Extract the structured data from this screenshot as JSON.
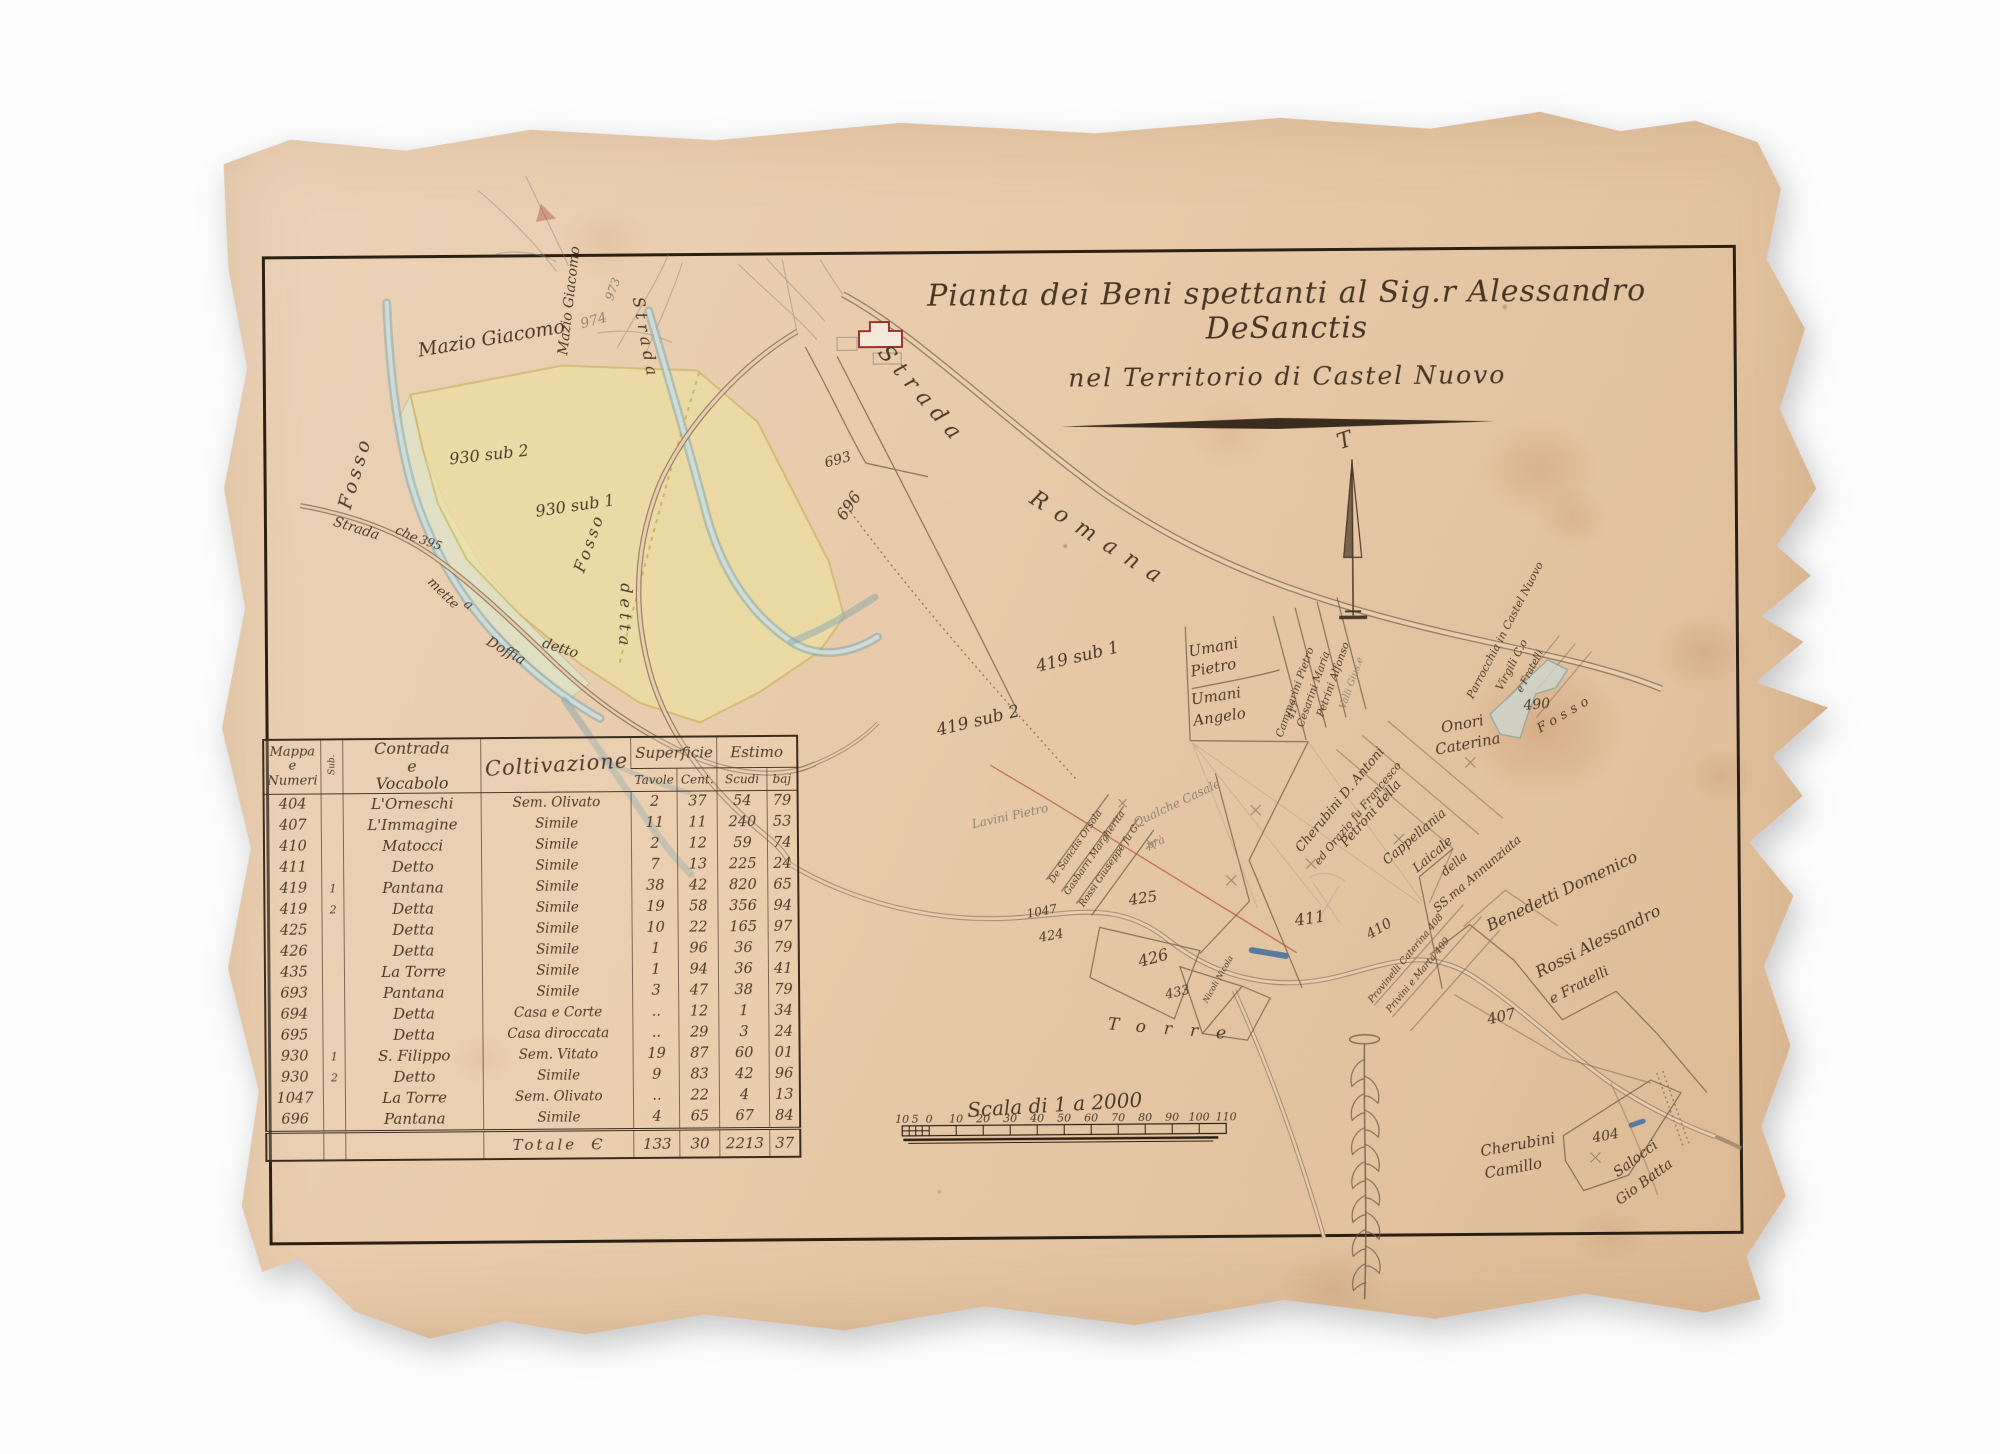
{
  "title": {
    "line1": "Pianta dei Beni spettanti al Sig.r Alessandro DeSanctis",
    "line2": "nel Territorio di Castel Nuovo"
  },
  "table": {
    "headers": {
      "mappa": "Mappa\ne\nNumeri",
      "sub": "Sub.",
      "contrada": "Contrada\ne\nVocabolo",
      "coltivazione": "Coltivazione",
      "superficie": "Superficie",
      "estimo": "Estimo",
      "tavole": "Tavole",
      "cent": "Cent.",
      "scudi": "Scudi",
      "baj": "baj"
    },
    "rows": [
      [
        "404",
        "",
        "L'Orneschi",
        "Sem. Olivato",
        "2",
        "37",
        "54",
        "79"
      ],
      [
        "407",
        "",
        "L'Immagine",
        "Simile",
        "11",
        "11",
        "240",
        "53"
      ],
      [
        "410",
        "",
        "Matocci",
        "Simile",
        "2",
        "12",
        "59",
        "74"
      ],
      [
        "411",
        "",
        "Detto",
        "Simile",
        "7",
        "13",
        "225",
        "24"
      ],
      [
        "419",
        "1",
        "Pantana",
        "Simile",
        "38",
        "42",
        "820",
        "65"
      ],
      [
        "419",
        "2",
        "Detta",
        "Simile",
        "19",
        "58",
        "356",
        "94"
      ],
      [
        "425",
        "",
        "Detta",
        "Simile",
        "10",
        "22",
        "165",
        "97"
      ],
      [
        "426",
        "",
        "Detta",
        "Simile",
        "1",
        "96",
        "36",
        "79"
      ],
      [
        "435",
        "",
        "La Torre",
        "Simile",
        "1",
        "94",
        "36",
        "41"
      ],
      [
        "693",
        "",
        "Pantana",
        "Simile",
        "3",
        "47",
        "38",
        "79"
      ],
      [
        "694",
        "",
        "Detta",
        "Casa e Corte",
        "..",
        "12",
        "1",
        "34"
      ],
      [
        "695",
        "",
        "Detta",
        "Casa diroccata",
        "..",
        "29",
        "3",
        "24"
      ],
      [
        "930",
        "1",
        "S. Filippo",
        "Sem. Vitato",
        "19",
        "87",
        "60",
        "01"
      ],
      [
        "930",
        "2",
        "Detto",
        "Simile",
        "9",
        "83",
        "42",
        "96"
      ],
      [
        "1047",
        "",
        "La Torre",
        "Sem. Olivato",
        "..",
        "22",
        "4",
        "13"
      ],
      [
        "696",
        "",
        "Pantana",
        "Simile",
        "4",
        "65",
        "67",
        "84"
      ]
    ],
    "total": {
      "label": "Totale",
      "symbol": "Є",
      "tavole": "133",
      "cent": "30",
      "scudi": "2213",
      "baj": "37"
    }
  },
  "scale_bar": {
    "label": "Scala di 1 a 2000",
    "ticks": [
      {
        "t": "10",
        "x": 899
      },
      {
        "t": "5",
        "x": 912
      },
      {
        "t": "0",
        "x": 926
      },
      {
        "t": "10",
        "x": 953
      },
      {
        "t": "20",
        "x": 980
      },
      {
        "t": "30",
        "x": 1007
      },
      {
        "t": "40",
        "x": 1034
      },
      {
        "t": "50",
        "x": 1061
      },
      {
        "t": "60",
        "x": 1088
      },
      {
        "t": "70",
        "x": 1115
      },
      {
        "t": "80",
        "x": 1142
      },
      {
        "t": "90",
        "x": 1169
      },
      {
        "t": "100",
        "x": 1196
      },
      {
        "t": "110",
        "x": 1223
      }
    ]
  },
  "north_arrow": {
    "letter": "T"
  },
  "inset_map": {
    "labels": [
      {
        "t": "Mazio Giacomo",
        "x": 422,
        "y": 352,
        "r": -9,
        "s": 19
      },
      {
        "t": "Mazio Giacomo",
        "x": 570,
        "y": 352,
        "r": -83,
        "s": 14
      },
      {
        "t": "Fosso",
        "x": 352,
        "y": 505,
        "r": -73,
        "s": 19,
        "ls": 4
      },
      {
        "t": "930 sub 2",
        "x": 452,
        "y": 460,
        "r": -6,
        "s": 16
      },
      {
        "t": "930 sub 1",
        "x": 538,
        "y": 513,
        "r": -8,
        "s": 16
      },
      {
        "t": "Fosso",
        "x": 585,
        "y": 570,
        "r": -70,
        "s": 16,
        "ls": 3
      },
      {
        "t": "Strada",
        "x": 334,
        "y": 520,
        "r": 18,
        "s": 14
      },
      {
        "t": "che",
        "x": 396,
        "y": 528,
        "r": 25,
        "s": 13
      },
      {
        "t": "395",
        "x": 420,
        "y": 538,
        "r": 20,
        "s": 12
      },
      {
        "t": "mette",
        "x": 428,
        "y": 578,
        "r": 45,
        "s": 13
      },
      {
        "t": "a",
        "x": 464,
        "y": 601,
        "r": 40,
        "s": 13
      },
      {
        "t": "Doffia",
        "x": 486,
        "y": 640,
        "r": 30,
        "s": 14
      },
      {
        "t": "detto",
        "x": 542,
        "y": 643,
        "r": 18,
        "s": 14
      },
      {
        "t": "974",
        "x": 585,
        "y": 325,
        "r": -15,
        "s": 14,
        "pencil": true
      },
      {
        "t": "973",
        "x": 616,
        "y": 298,
        "r": -70,
        "s": 12,
        "pencil": true
      }
    ]
  },
  "main_map": {
    "labels": [
      {
        "t": "Strada",
        "x": 880,
        "y": 352,
        "r": 50,
        "s": 22,
        "ls": 8
      },
      {
        "t": "Romana",
        "x": 1030,
        "y": 502,
        "r": 33,
        "s": 22,
        "ls": 12
      },
      {
        "t": "Strada",
        "x": 636,
        "y": 295,
        "r": 80,
        "s": 16,
        "ls": 5
      },
      {
        "t": "detta",
        "x": 622,
        "y": 580,
        "r": 92,
        "s": 16,
        "ls": 5
      },
      {
        "t": "693",
        "x": 828,
        "y": 466,
        "r": -15,
        "s": 14
      },
      {
        "t": "696",
        "x": 846,
        "y": 520,
        "r": -55,
        "s": 16
      },
      {
        "t": "419 sub 1",
        "x": 1038,
        "y": 672,
        "r": -13,
        "s": 17
      },
      {
        "t": "419 sub 2",
        "x": 938,
        "y": 735,
        "r": -13,
        "s": 17
      },
      {
        "t": "Umani",
        "x": 1190,
        "y": 658,
        "r": -10,
        "s": 15
      },
      {
        "t": "Pietro",
        "x": 1192,
        "y": 678,
        "r": -10,
        "s": 15
      },
      {
        "t": "Umani",
        "x": 1192,
        "y": 706,
        "r": -8,
        "s": 15
      },
      {
        "t": "Angelo",
        "x": 1194,
        "y": 727,
        "r": -8,
        "s": 15
      },
      {
        "t": "Cammarini Pietro",
        "x": 1282,
        "y": 740,
        "r": -70,
        "s": 10.5
      },
      {
        "t": "417",
        "x": 1293,
        "y": 722,
        "r": -70,
        "s": 9.5
      },
      {
        "t": "Cesarini Maria",
        "x": 1303,
        "y": 730,
        "r": -70,
        "s": 10.5
      },
      {
        "t": "Petrini Alfonso",
        "x": 1323,
        "y": 720,
        "r": -70,
        "s": 10.5
      },
      {
        "t": "Valli Gius.e",
        "x": 1345,
        "y": 712,
        "r": -70,
        "s": 9.5,
        "pencil": true
      },
      {
        "t": "Lavini Pietro",
        "x": 972,
        "y": 828,
        "r": -12,
        "s": 12,
        "pencil": true
      },
      {
        "t": "Cherubini D. Antoni",
        "x": 1300,
        "y": 855,
        "r": -50,
        "s": 13
      },
      {
        "t": "ed Orazio fu Francesco",
        "x": 1318,
        "y": 868,
        "r": -50,
        "s": 11
      },
      {
        "t": "Petroni della",
        "x": 1345,
        "y": 850,
        "r": -48,
        "s": 13
      },
      {
        "t": "Cappellania",
        "x": 1386,
        "y": 868,
        "r": -40,
        "s": 13
      },
      {
        "t": "Laicale",
        "x": 1416,
        "y": 876,
        "r": -40,
        "s": 13
      },
      {
        "t": "della",
        "x": 1444,
        "y": 880,
        "r": -40,
        "s": 12
      },
      {
        "t": "SS.ma Annunziata",
        "x": 1436,
        "y": 916,
        "r": -40,
        "s": 12
      },
      {
        "t": "Parrocchia in Castel Nuovo",
        "x": 1473,
        "y": 703,
        "r": -62,
        "s": 11
      },
      {
        "t": "Virgili C.o",
        "x": 1502,
        "y": 695,
        "r": -62,
        "s": 11
      },
      {
        "t": "e Fratelli",
        "x": 1522,
        "y": 697,
        "r": -62,
        "s": 10
      },
      {
        "t": "Onori",
        "x": 1442,
        "y": 736,
        "r": -10,
        "s": 15
      },
      {
        "t": "Caterina",
        "x": 1436,
        "y": 758,
        "r": -10,
        "s": 15
      },
      {
        "t": "490",
        "x": 1524,
        "y": 714,
        "r": -5,
        "s": 14
      },
      {
        "t": "Fosso",
        "x": 1540,
        "y": 737,
        "r": -30,
        "s": 13,
        "ls": 5
      },
      {
        "t": "Benedetti Domenico",
        "x": 1488,
        "y": 935,
        "r": -25,
        "s": 16
      },
      {
        "t": "Rossi Alessandro",
        "x": 1537,
        "y": 982,
        "r": -27,
        "s": 16
      },
      {
        "t": "e Fratelli",
        "x": 1550,
        "y": 1008,
        "r": -27,
        "s": 14
      },
      {
        "t": "407",
        "x": 1486,
        "y": 1028,
        "r": -12,
        "s": 15
      },
      {
        "t": "Torre",
        "x": 1105,
        "y": 1030,
        "r": 5,
        "s": 17,
        "ls": 18
      },
      {
        "t": "1047",
        "x": 1026,
        "y": 918,
        "r": -10,
        "s": 12
      },
      {
        "t": "424",
        "x": 1038,
        "y": 942,
        "r": -10,
        "s": 13
      },
      {
        "t": "425",
        "x": 1128,
        "y": 906,
        "r": -8,
        "s": 15
      },
      {
        "t": "426",
        "x": 1138,
        "y": 968,
        "r": -15,
        "s": 16
      },
      {
        "t": "433",
        "x": 1164,
        "y": 1000,
        "r": -12,
        "s": 13
      },
      {
        "t": "Nicoli Nicola",
        "x": 1205,
        "y": 1005,
        "r": -60,
        "s": 8
      },
      {
        "t": "De Sanctis Orsola",
        "x": 1052,
        "y": 884,
        "r": -55,
        "s": 9.5
      },
      {
        "t": "Gasbarri Margherita",
        "x": 1067,
        "y": 896,
        "r": -55,
        "s": 9.5
      },
      {
        "t": "Rossi Giuseppe fu G.",
        "x": 1082,
        "y": 908,
        "r": -55,
        "s": 9.5
      },
      {
        "t": "Qualche Casale",
        "x": 1135,
        "y": 828,
        "r": -25,
        "s": 12,
        "pencil": true
      },
      {
        "t": "prà",
        "x": 1147,
        "y": 850,
        "r": -20,
        "s": 11,
        "pencil": true
      },
      {
        "t": "411",
        "x": 1294,
        "y": 928,
        "r": -8,
        "s": 16
      },
      {
        "t": "410",
        "x": 1368,
        "y": 942,
        "r": -30,
        "s": 14
      },
      {
        "t": "Provinelli Caterina 408",
        "x": 1370,
        "y": 1006,
        "r": -50,
        "s": 9.5
      },
      {
        "t": "Privini e Marta 409",
        "x": 1388,
        "y": 1016,
        "r": -50,
        "s": 9.5
      },
      {
        "t": "Cherubini",
        "x": 1478,
        "y": 1160,
        "r": -10,
        "s": 15
      },
      {
        "t": "Camillo",
        "x": 1482,
        "y": 1182,
        "r": -10,
        "s": 15
      },
      {
        "t": "404",
        "x": 1590,
        "y": 1147,
        "r": -10,
        "s": 14
      },
      {
        "t": "Salocci",
        "x": 1614,
        "y": 1182,
        "r": -36,
        "s": 14
      },
      {
        "t": "Gio Batta",
        "x": 1616,
        "y": 1210,
        "r": -36,
        "s": 14
      },
      {
        "t": "T",
        "x": 1342,
        "y": 452,
        "r": -18,
        "s": 22
      }
    ]
  },
  "colors": {
    "paper": "#e7cbae",
    "ink": "#4c3a29",
    "frame": "#2a2014",
    "stream": "#85a7ac",
    "parcel_yellow": "#efe2a2",
    "parcel_green": "#dfe4c9",
    "house_red": "#9c312d",
    "pen_blue": "#3f6fa0",
    "stain": "#b06f3d",
    "pencil": "#8d8476"
  }
}
